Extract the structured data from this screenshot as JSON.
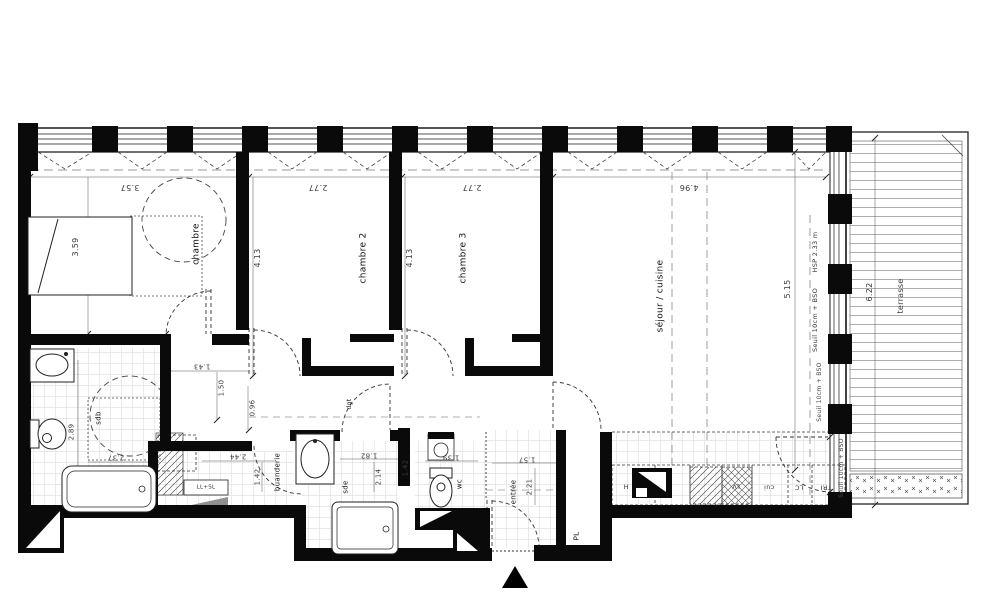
{
  "rooms": {
    "chambre": "chambre",
    "chambre2": "chambre 2",
    "chambre3": "chambre 3",
    "sejour": "séjour / cuisine",
    "terrasse": "terrasse",
    "sdb": "sdb",
    "buanderie": "buanderie",
    "sde": "sde",
    "wc": "wc",
    "dgt": "dgt",
    "entree": "entrée",
    "placard": "PL"
  },
  "dims": {
    "chambre_w": "3.57",
    "chambre_h": "3.59",
    "chambre2_w": "2.77",
    "chambre2_h": "4.13",
    "chambre3_w": "2.77",
    "chambre3_h": "4.13",
    "sejour_w": "4.96",
    "sejour_h": "5.15",
    "terrasse_l": "6.22",
    "sdb_h": "2.89",
    "sdb_w": "2.37",
    "dgt_a": "1.43",
    "dgt_b": "1.50",
    "dgt_c": "0.96",
    "buanderie_w": "2.44",
    "buanderie_h": "1.42",
    "sde_w": "1.82",
    "sde_h": "2.14",
    "wc_w": "1.39",
    "wc_h": "1.42",
    "entree_w": "1.57",
    "entree_h": "2.21"
  },
  "notes": {
    "hsp": "HSP 2.33 m",
    "seuil_a": "Seuil 10cm + BSO",
    "seuil_b": "Seuil 10cm + BSO",
    "seuil_c": "Seuil 10cm + BSO",
    "machine": "LL+SL"
  },
  "kitchen": {
    "hotte": "H",
    "lave_vaisselle": "LV",
    "cuisson": "cui",
    "lc": "LC",
    "tri": "TRI"
  },
  "colors": {
    "wall": "#0a0a0a",
    "line": "#222222",
    "dash": "#888888",
    "tile": "#dddddd",
    "background": "#ffffff"
  }
}
